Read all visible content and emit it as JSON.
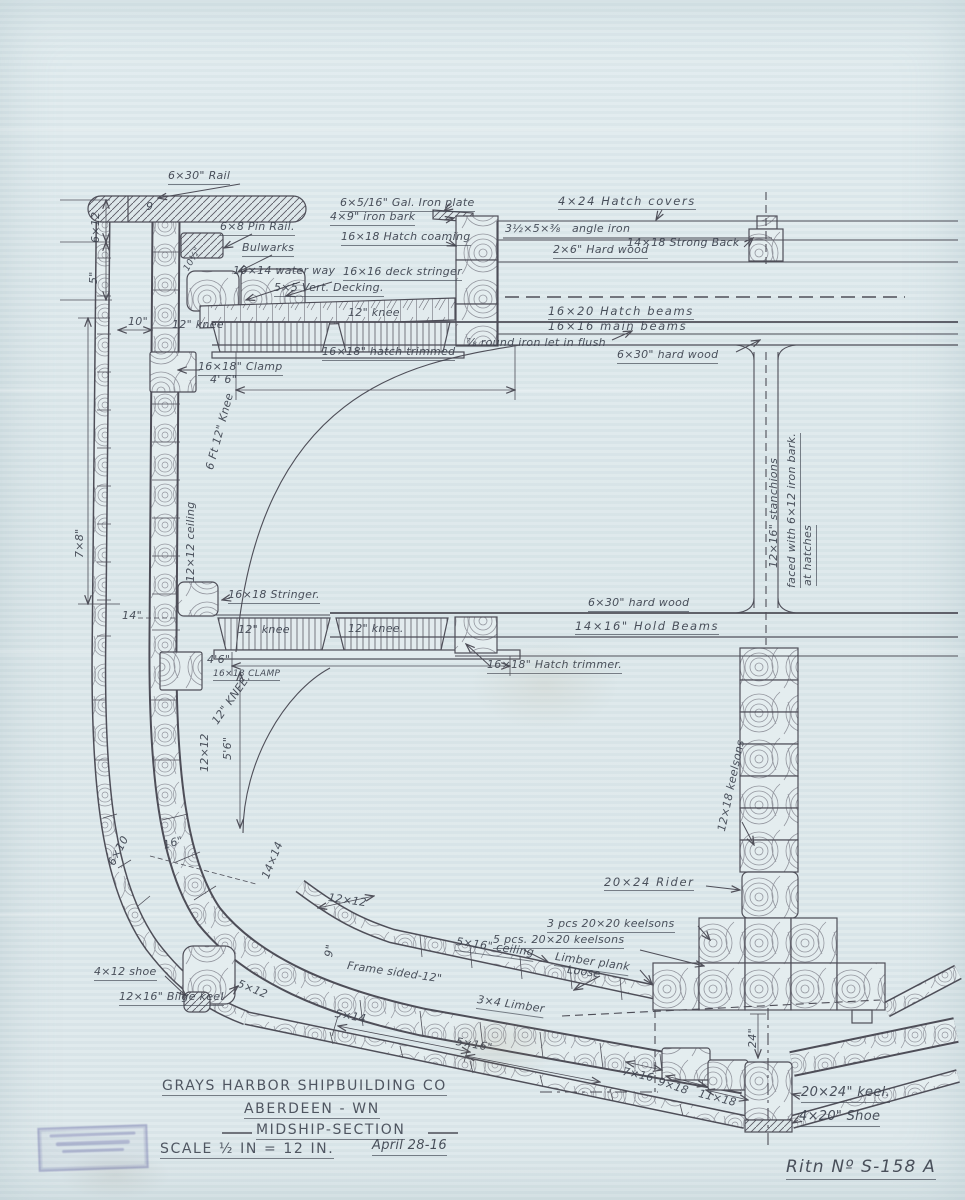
{
  "colors": {
    "paper": "#dfe9ec",
    "pencil": "#4e4e58",
    "ink_text": "#3e4450",
    "stamp_ink": "#5b5ba6"
  },
  "title_block": {
    "company": "GRAYS HARBOR SHIPBUILDING CO",
    "location": "ABERDEEN - WN",
    "drawing_title": "MIDSHIP-SECTION",
    "scale": "SCALE ½ IN = 12 IN.",
    "date": "April 28-16",
    "drawing_number": "Ritn Nº S-158 A"
  },
  "stamp": {
    "legible": false
  },
  "labels": [
    {
      "n": "label-rail",
      "t": "6×30\" Rail",
      "x": 168,
      "y": 170,
      "c": "u"
    },
    {
      "n": "label-rail-mark",
      "t": "9",
      "x": 146,
      "y": 201
    },
    {
      "n": "label-pin-rail",
      "t": "6×8 Pin Rail.",
      "x": 220,
      "y": 221,
      "c": "u"
    },
    {
      "n": "label-bulwarks",
      "t": "Bulwarks",
      "x": 242,
      "y": 242,
      "c": "u"
    },
    {
      "n": "label-waterway",
      "t": "10×14 water way",
      "x": 233,
      "y": 265
    },
    {
      "n": "label-vert-decking",
      "t": "5×5 Vert. Decking.",
      "x": 274,
      "y": 282,
      "c": "u"
    },
    {
      "n": "label-deck-stringer",
      "t": "16×16 deck stringer",
      "x": 343,
      "y": 266,
      "c": "u"
    },
    {
      "n": "label-hatch-coaming",
      "t": "16×18 Hatch coaming",
      "x": 341,
      "y": 231,
      "c": "u"
    },
    {
      "n": "label-gal-iron-plate",
      "t": "6×5/16\" Gal. Iron plate",
      "x": 340,
      "y": 197,
      "c": "u"
    },
    {
      "n": "label-iron-bark",
      "t": "4×9\" iron bark",
      "x": 330,
      "y": 211,
      "c": "u"
    },
    {
      "n": "label-hatch-covers",
      "t": "4×24 Hatch covers",
      "x": 558,
      "y": 195,
      "c": "u sp"
    },
    {
      "n": "label-angle-iron",
      "t": "3½×5×⅜   angle iron",
      "x": 505,
      "y": 223
    },
    {
      "n": "label-hard-wood-2x6",
      "t": "2×6\" Hard wood",
      "x": 553,
      "y": 244,
      "c": "u"
    },
    {
      "n": "label-strong-back",
      "t": "14×18 Strong Back",
      "x": 627,
      "y": 237
    },
    {
      "n": "label-hatch-beams",
      "t": "16×20 Hatch beams",
      "x": 548,
      "y": 305,
      "c": "u sp"
    },
    {
      "n": "label-main-beams",
      "t": "16×16 main beams",
      "x": 548,
      "y": 320,
      "c": "sp"
    },
    {
      "n": "label-hatch-trimmed",
      "t": "16×18\" hatch trimmed",
      "x": 322,
      "y": 346,
      "c": "u"
    },
    {
      "n": "label-round-iron",
      "t": "⅞ round iron let in flush",
      "x": 466,
      "y": 337
    },
    {
      "n": "label-hard-wood-6x30-top",
      "t": "6×30\" hard wood",
      "x": 617,
      "y": 349,
      "c": "u"
    },
    {
      "n": "label-clamp-upper",
      "t": "16×18\" Clamp",
      "x": 198,
      "y": 361,
      "c": "u"
    },
    {
      "n": "label-dim-4ft6-upper",
      "t": "4' 6\"",
      "x": 210,
      "y": 374
    },
    {
      "n": "label-knee-6ft",
      "t": "6 Ft 12\" Knee",
      "x": 204,
      "y": 468,
      "r": -75
    },
    {
      "n": "label-ceiling-12x12",
      "t": "12×12 ceiling",
      "x": 185,
      "y": 582,
      "r": -90
    },
    {
      "n": "label-dim-7x8",
      "t": "7×8\"",
      "x": 74,
      "y": 558,
      "r": -90
    },
    {
      "n": "label-dim-6x12",
      "t": "6×12",
      "x": 90,
      "y": 243,
      "r": -90
    },
    {
      "n": "label-dim-5",
      "t": "5\"",
      "x": 88,
      "y": 284,
      "r": -90
    },
    {
      "n": "label-dim-10half",
      "t": "10½\"",
      "x": 182,
      "y": 268,
      "r": -60,
      "c": "s9"
    },
    {
      "n": "label-dim-10",
      "t": "10\"",
      "x": 128,
      "y": 316
    },
    {
      "n": "label-knee-deck-port",
      "t": "12\" knee",
      "x": 172,
      "y": 319
    },
    {
      "n": "label-knee-deck-stbd",
      "t": "12\" knee",
      "x": 348,
      "y": 307
    },
    {
      "n": "label-dim-14",
      "t": "14\"",
      "x": 122,
      "y": 610
    },
    {
      "n": "label-stringer",
      "t": "16×18 Stringer.",
      "x": 228,
      "y": 589,
      "c": "u"
    },
    {
      "n": "label-knee-hold-port",
      "t": "12\" knee",
      "x": 238,
      "y": 624
    },
    {
      "n": "label-knee-hold-stbd",
      "t": "12\" knee.",
      "x": 348,
      "y": 623
    },
    {
      "n": "label-dim-4ft6-lower",
      "t": "4'6\"",
      "x": 207,
      "y": 654
    },
    {
      "n": "label-clamp-lower",
      "t": "16×18 CLAMP",
      "x": 213,
      "y": 669,
      "c": "u s9"
    },
    {
      "n": "label-knee-12-rot",
      "t": "12\" KNEE.",
      "x": 210,
      "y": 720,
      "r": -55
    },
    {
      "n": "label-dim-12x12-side",
      "t": "12×12",
      "x": 199,
      "y": 772,
      "r": -90
    },
    {
      "n": "label-dim-5ft6",
      "t": "5'6\"",
      "x": 222,
      "y": 760,
      "r": -90
    },
    {
      "n": "label-hard-wood-6x30-mid",
      "t": "6×30\" hard wood",
      "x": 588,
      "y": 597,
      "c": "u"
    },
    {
      "n": "label-hold-beams",
      "t": "14×16\" Hold Beams",
      "x": 575,
      "y": 620,
      "c": "u sp"
    },
    {
      "n": "label-hatch-trimmer",
      "t": "16×18\" Hatch trimmer.",
      "x": 487,
      "y": 659,
      "c": "u"
    },
    {
      "n": "label-stanchions",
      "t": "12×16\" stanchions",
      "x": 768,
      "y": 568,
      "r": -90
    },
    {
      "n": "label-stanchion-facing",
      "t": "faced with 6×12 iron bark.",
      "x": 786,
      "y": 588,
      "r": -90,
      "c": "u"
    },
    {
      "n": "label-at-hatches",
      "t": "at hatches",
      "x": 802,
      "y": 586,
      "r": -90,
      "c": "u"
    },
    {
      "n": "label-keelsons-12x18",
      "t": "12×18 keelsons",
      "x": 716,
      "y": 830,
      "r": -78
    },
    {
      "n": "label-rider",
      "t": "20×24 Rider",
      "x": 604,
      "y": 876,
      "c": "u sp"
    },
    {
      "n": "label-keelsons-3pcs",
      "t": "3 pcs 20×20 keelsons",
      "x": 547,
      "y": 918,
      "c": "u"
    },
    {
      "n": "label-keelsons-5pcs",
      "t": "5 pcs. 20×20 keelsons",
      "x": 493,
      "y": 934,
      "c": "u"
    },
    {
      "n": "label-ceiling-5x16",
      "t": "5×16\" ceiling",
      "x": 457,
      "y": 936,
      "r": 8,
      "c": "u"
    },
    {
      "n": "label-limber-plank",
      "t": "Limber plank",
      "x": 556,
      "y": 951,
      "r": 8,
      "c": "u"
    },
    {
      "n": "label-limber-plank-loose",
      "t": "Loose",
      "x": 568,
      "y": 964,
      "r": 8
    },
    {
      "n": "label-limber-3x4",
      "t": "3×4 Limber",
      "x": 478,
      "y": 994,
      "r": 8,
      "c": "u"
    },
    {
      "n": "label-frame-sided",
      "t": "Frame sided-12\"",
      "x": 348,
      "y": 960,
      "r": 8
    },
    {
      "n": "label-dim-9",
      "t": "9\"",
      "x": 323,
      "y": 956,
      "r": -80
    },
    {
      "n": "label-shoe-4x12",
      "t": "4×12 shoe",
      "x": 94,
      "y": 966,
      "c": "u"
    },
    {
      "n": "label-bilge-keel",
      "t": "12×16\" Bilge keel",
      "x": 119,
      "y": 991,
      "c": "u"
    },
    {
      "n": "label-dim-5x12",
      "t": "5×12",
      "x": 240,
      "y": 978,
      "r": 22
    },
    {
      "n": "label-dim-5x14",
      "t": "5×14",
      "x": 336,
      "y": 1008,
      "r": 10
    },
    {
      "n": "label-dim-5x16",
      "t": "5×16\"",
      "x": 457,
      "y": 1036,
      "r": 10
    },
    {
      "n": "label-dim-12x12-bilge",
      "t": "12×12",
      "x": 329,
      "y": 892,
      "r": 8
    },
    {
      "n": "label-dim-14x14",
      "t": "14×14",
      "x": 260,
      "y": 876,
      "r": -68
    },
    {
      "n": "label-dim-16",
      "t": "16\"",
      "x": 162,
      "y": 840,
      "r": -15
    },
    {
      "n": "label-dim-6x10",
      "t": "6×10",
      "x": 106,
      "y": 862,
      "r": -62
    },
    {
      "n": "label-dim-7x16",
      "t": "7×16",
      "x": 624,
      "y": 1066,
      "r": 12
    },
    {
      "n": "label-dim-9x18",
      "t": "9×18",
      "x": 660,
      "y": 1076,
      "r": 18
    },
    {
      "n": "label-dim-11x18",
      "t": "11×18",
      "x": 700,
      "y": 1088,
      "r": 14
    },
    {
      "n": "label-dim-24",
      "t": "24\"",
      "x": 747,
      "y": 1048,
      "r": -90
    },
    {
      "n": "label-keel",
      "t": "20×24\" keel.",
      "x": 801,
      "y": 1086,
      "c": "u s13"
    },
    {
      "n": "label-keel-shoe",
      "t": "4×20\" Shoe",
      "x": 799,
      "y": 1110,
      "c": "u s13"
    },
    {
      "n": "label-company",
      "t": "GRAYS HARBOR SHIPBUILDING CO",
      "x": 162,
      "y": 1078,
      "c": "caps u"
    },
    {
      "n": "label-location",
      "t": "ABERDEEN - WN",
      "x": 244,
      "y": 1101,
      "c": "caps u"
    },
    {
      "n": "label-drawing-title",
      "t": "MIDSHIP-SECTION",
      "x": 256,
      "y": 1122,
      "c": "caps u"
    },
    {
      "n": "label-scale",
      "t": "SCALE ½ IN = 12 IN.",
      "x": 160,
      "y": 1141,
      "c": "caps u s12"
    },
    {
      "n": "label-date",
      "t": "April 28-16",
      "x": 372,
      "y": 1139,
      "c": "u s13"
    },
    {
      "n": "label-drawing-number",
      "t": "Ritn Nº S-158 A",
      "x": 786,
      "y": 1158,
      "c": "big u"
    }
  ]
}
